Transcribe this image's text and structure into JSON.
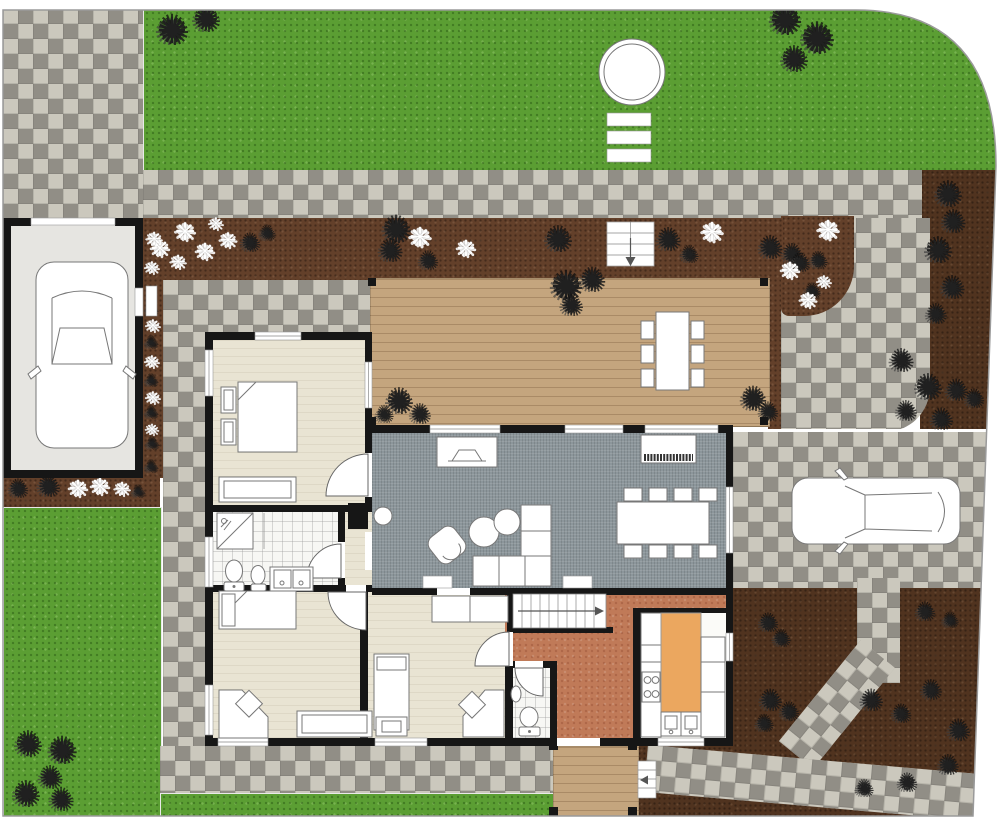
{
  "plan": {
    "kind": "residential-site-floor-plan",
    "orientation": "top-view"
  },
  "colors": {
    "grass": "#5b9e33",
    "paver_light": "#cbc8bd",
    "paver_dark": "#918e86",
    "mulch": "#63402a",
    "mulch_dark": "#50331f",
    "deck_wood": "#c4a57e",
    "wall": "#161616",
    "room_beige": "#e9e4d3",
    "room_gray": "#8c969b",
    "room_tile": "#f7f7f4",
    "room_terracotta": "#c07a58",
    "kitchen_island": "#eba75f",
    "garage_floor": "#e6e5e1",
    "furniture_fill": "#ffffff",
    "furniture_stroke": "#777777",
    "boundary": "#9a9a9a"
  },
  "glyphs": {
    "shrub": "✺",
    "flower": "❋"
  },
  "plants": {
    "shrubs": [
      [
        172,
        32,
        36
      ],
      [
        206,
        21,
        30
      ],
      [
        785,
        22,
        36
      ],
      [
        817,
        39,
        38
      ],
      [
        794,
        61,
        30
      ],
      [
        250,
        243,
        20
      ],
      [
        267,
        234,
        16
      ],
      [
        396,
        230,
        32
      ],
      [
        390,
        252,
        26
      ],
      [
        428,
        261,
        20
      ],
      [
        558,
        241,
        30
      ],
      [
        668,
        241,
        26
      ],
      [
        689,
        256,
        18
      ],
      [
        770,
        249,
        26
      ],
      [
        792,
        256,
        22
      ],
      [
        948,
        196,
        30
      ],
      [
        953,
        223,
        26
      ],
      [
        938,
        252,
        30
      ],
      [
        952,
        289,
        26
      ],
      [
        936,
        316,
        22
      ],
      [
        901,
        362,
        26
      ],
      [
        928,
        389,
        30
      ],
      [
        956,
        391,
        24
      ],
      [
        906,
        413,
        22
      ],
      [
        941,
        420,
        24
      ],
      [
        974,
        399,
        20
      ],
      [
        800,
        263,
        20
      ],
      [
        818,
        262,
        18
      ],
      [
        812,
        292,
        16
      ],
      [
        151,
        310,
        12
      ],
      [
        151,
        343,
        12
      ],
      [
        151,
        381,
        12
      ],
      [
        151,
        413,
        12
      ],
      [
        152,
        444,
        12
      ],
      [
        151,
        467,
        12
      ],
      [
        18,
        489,
        20
      ],
      [
        48,
        487,
        24
      ],
      [
        138,
        492,
        12
      ],
      [
        28,
        746,
        30
      ],
      [
        62,
        751,
        32
      ],
      [
        50,
        779,
        26
      ],
      [
        26,
        796,
        30
      ],
      [
        61,
        801,
        26
      ],
      [
        566,
        288,
        36
      ],
      [
        592,
        281,
        28
      ],
      [
        571,
        306,
        24
      ],
      [
        399,
        403,
        30
      ],
      [
        420,
        416,
        22
      ],
      [
        384,
        416,
        18
      ],
      [
        753,
        400,
        28
      ],
      [
        768,
        412,
        20
      ],
      [
        925,
        612,
        20
      ],
      [
        950,
        621,
        16
      ],
      [
        768,
        623,
        20
      ],
      [
        781,
        640,
        18
      ],
      [
        770,
        701,
        24
      ],
      [
        789,
        712,
        20
      ],
      [
        764,
        725,
        18
      ],
      [
        871,
        701,
        24
      ],
      [
        901,
        714,
        20
      ],
      [
        931,
        692,
        22
      ],
      [
        958,
        731,
        24
      ],
      [
        984,
        744,
        18
      ],
      [
        948,
        767,
        22
      ],
      [
        907,
        783,
        20
      ],
      [
        864,
        790,
        18
      ]
    ],
    "flowers": [
      [
        185,
        232,
        24
      ],
      [
        160,
        250,
        22
      ],
      [
        205,
        253,
        22
      ],
      [
        228,
        240,
        20
      ],
      [
        178,
        263,
        18
      ],
      [
        216,
        224,
        16
      ],
      [
        420,
        238,
        26
      ],
      [
        466,
        250,
        22
      ],
      [
        712,
        233,
        26
      ],
      [
        828,
        231,
        26
      ],
      [
        790,
        272,
        22
      ],
      [
        808,
        300,
        20
      ],
      [
        824,
        282,
        16
      ],
      [
        154,
        240,
        18
      ],
      [
        152,
        268,
        16
      ],
      [
        153,
        326,
        16
      ],
      [
        152,
        362,
        16
      ],
      [
        153,
        398,
        16
      ],
      [
        152,
        430,
        14
      ],
      [
        78,
        490,
        22
      ],
      [
        100,
        488,
        22
      ],
      [
        122,
        490,
        18
      ]
    ]
  },
  "rooms": [
    {
      "name": "garage"
    },
    {
      "name": "bedroom-1"
    },
    {
      "name": "bathroom"
    },
    {
      "name": "hallway"
    },
    {
      "name": "bedroom-2"
    },
    {
      "name": "bedroom-3"
    },
    {
      "name": "wc"
    },
    {
      "name": "entry-hall"
    },
    {
      "name": "kitchen"
    },
    {
      "name": "living-dining-room"
    },
    {
      "name": "deck"
    },
    {
      "name": "porch"
    },
    {
      "name": "driveway"
    },
    {
      "name": "front-lawn"
    },
    {
      "name": "side-lawn"
    }
  ],
  "objects": [
    "double-bed",
    "single-bed",
    "nightstands",
    "wardrobe",
    "dressers",
    "corner-desks",
    "desk-chairs",
    "sectional-sofa",
    "armchair",
    "coffee-tables",
    "tv-console",
    "piano",
    "dining-table-8-chairs",
    "outdoor-dining-table-6-chairs",
    "round-garden-table",
    "garden-steps",
    "deck-steps",
    "porch-steps",
    "interior-staircase",
    "kitchen-island",
    "stove",
    "kitchen-sinks",
    "shower",
    "toilets",
    "bidet",
    "double-vanity",
    "washbasin",
    "car-in-garage",
    "car-on-driveway"
  ]
}
